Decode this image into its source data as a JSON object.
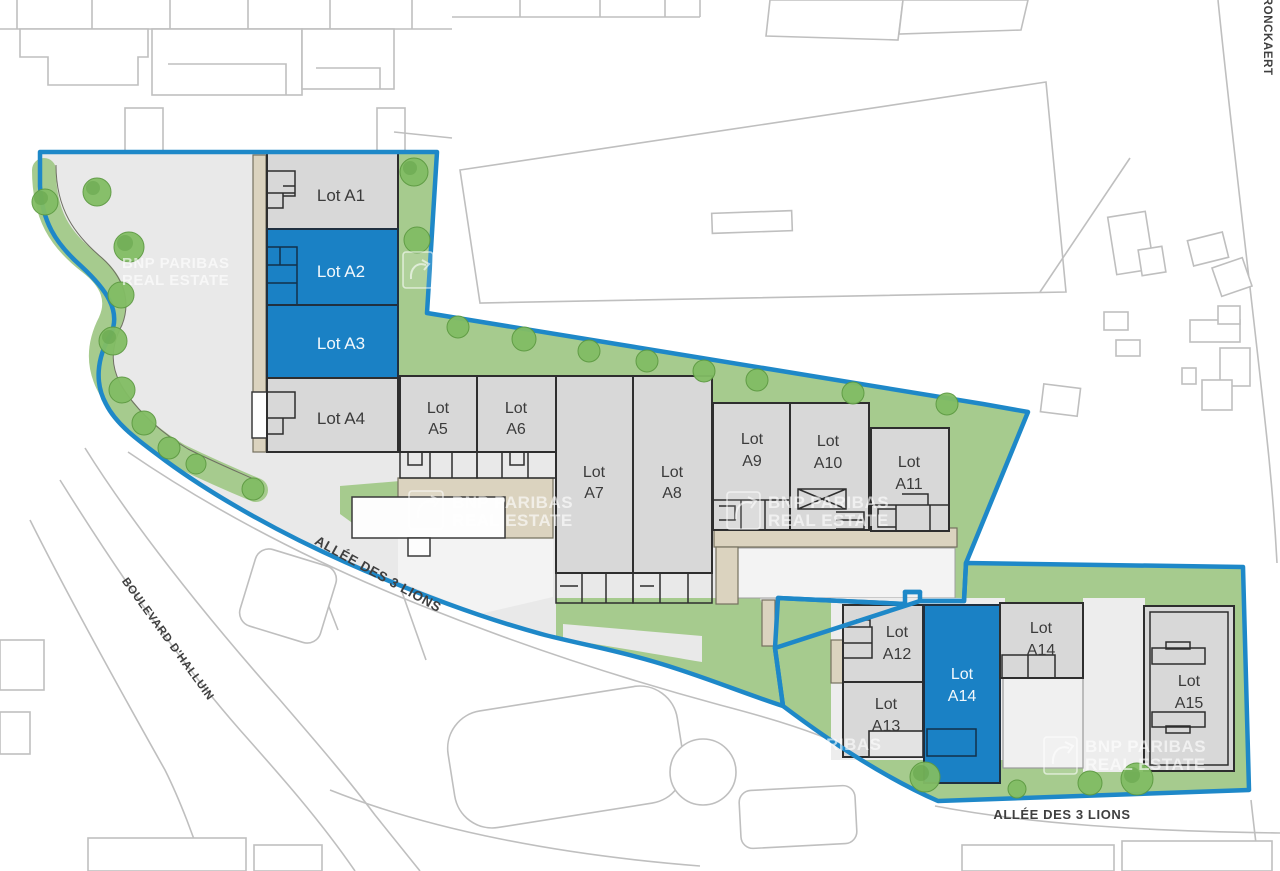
{
  "brand": {
    "line1": "BNP PARIBAS",
    "line2": "REAL ESTATE",
    "partial_line1": "P PARIBAS",
    "partial_line2": "ESTATE"
  },
  "streets": {
    "allee_upper": "ALLÉE DES 3 LIONS",
    "allee_lower": "ALLÉE DES 3 LIONS",
    "boulevard": "BOULEVARD D'HALLUIN",
    "rue": "RUE DU DRONCKAERT"
  },
  "lots": {
    "a1": {
      "label": "Lot A1",
      "highlighted": false
    },
    "a2": {
      "label": "Lot A2",
      "highlighted": true
    },
    "a3": {
      "label": "Lot A3",
      "highlighted": true
    },
    "a4": {
      "label": "Lot A4",
      "highlighted": false
    },
    "a5": {
      "line1": "Lot",
      "line2": "A5",
      "highlighted": false
    },
    "a6": {
      "line1": "Lot",
      "line2": "A6",
      "highlighted": false
    },
    "a7": {
      "line1": "Lot",
      "line2": "A7",
      "highlighted": false
    },
    "a8": {
      "line1": "Lot",
      "line2": "A8",
      "highlighted": false
    },
    "a9": {
      "line1": "Lot",
      "line2": "A9",
      "highlighted": false
    },
    "a10": {
      "line1": "Lot",
      "line2": "A10",
      "highlighted": false
    },
    "a11": {
      "line1": "Lot",
      "line2": "A11",
      "highlighted": false
    },
    "a12": {
      "line1": "Lot",
      "line2": "A12",
      "highlighted": false
    },
    "a13": {
      "line1": "Lot",
      "line2": "A13",
      "highlighted": false
    },
    "a14_main": {
      "line1": "Lot",
      "line2": "A14",
      "highlighted": true
    },
    "a14_small": {
      "line1": "Lot",
      "line2": "A14",
      "highlighted": false
    },
    "a15": {
      "line1": "Lot",
      "line2": "A15",
      "highlighted": false
    }
  },
  "colors": {
    "highlight_blue": "#1a81c5",
    "boundary_blue": "#1e88c8",
    "building_gray": "#d8d8d8",
    "landscape_green": "#a6cb8e",
    "path_beige": "#dbd3bf",
    "pavement_gray": "#e9e9e9"
  }
}
